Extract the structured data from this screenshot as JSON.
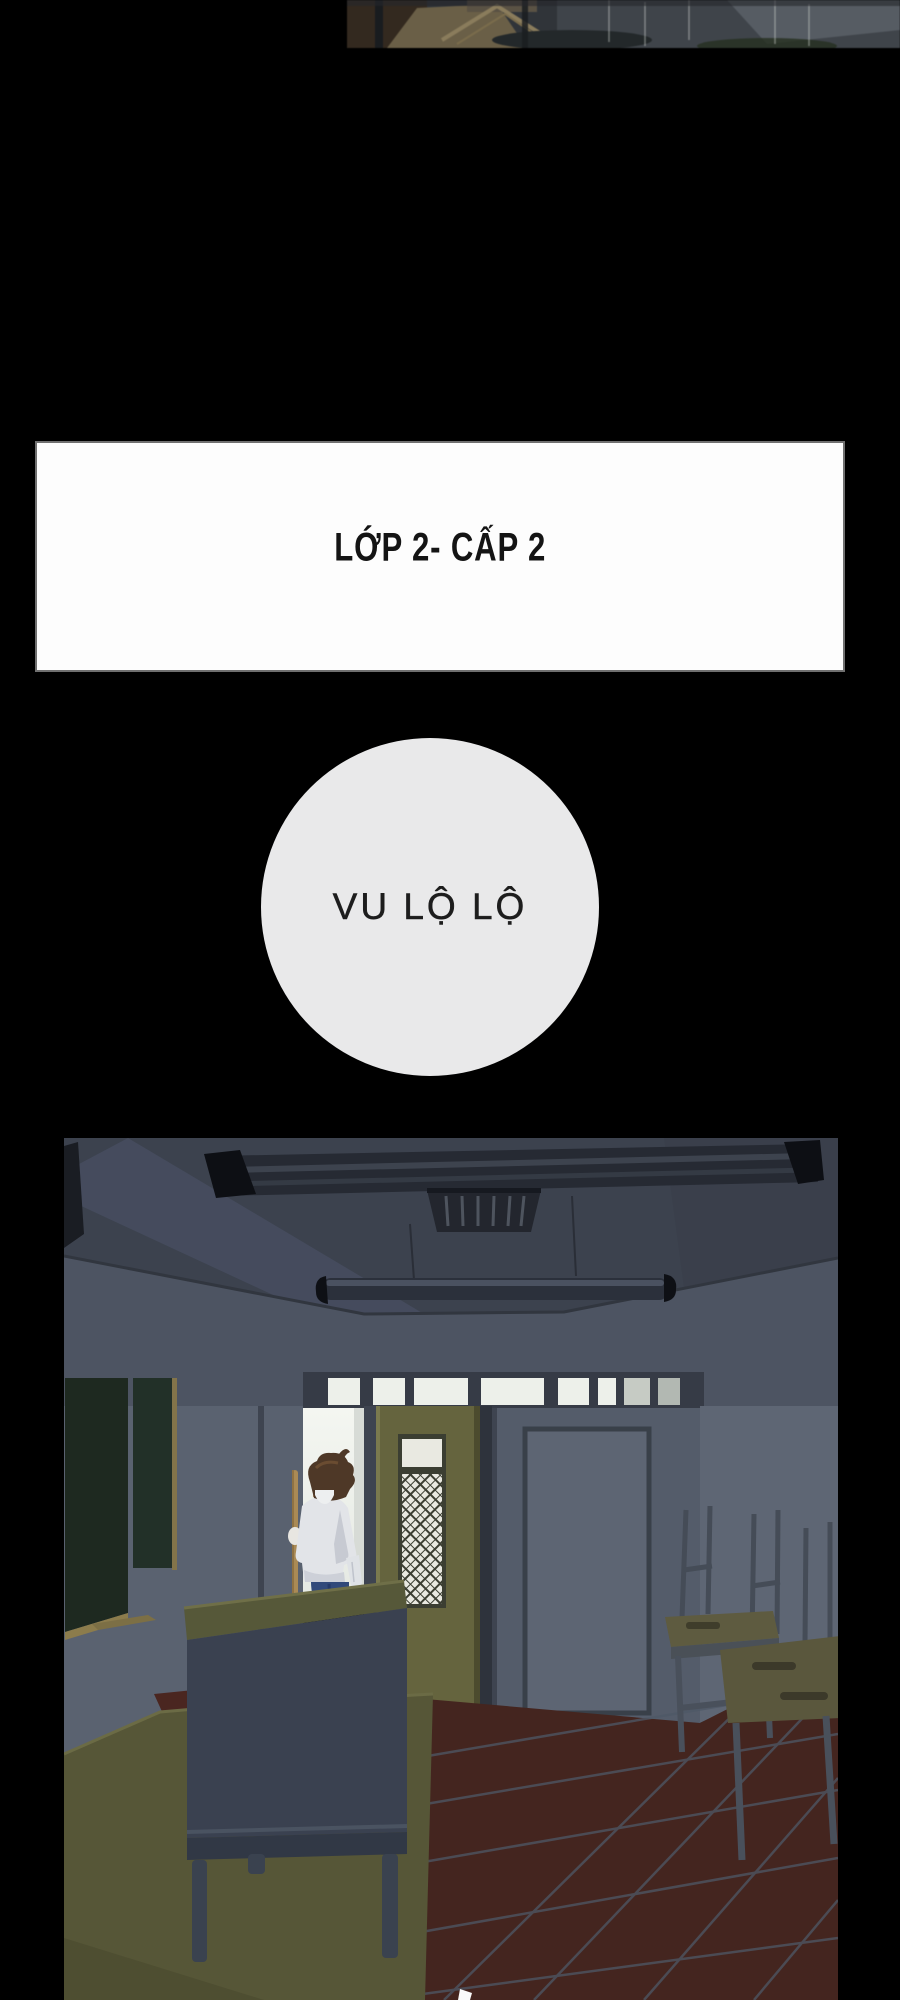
{
  "page": {
    "width": 900,
    "height": 2000,
    "background": "#000000"
  },
  "top_strip": {
    "description": "dark cropped classroom photo fragment at top edge of comic page"
  },
  "title_box": {
    "text": "LỚP 2- CẤP 2",
    "background": "#fdfdfd",
    "border_color": "#707070",
    "text_color": "#141414"
  },
  "name_circle": {
    "text": "VU LỘ LỘ",
    "background": "#e9e9ea",
    "text_color": "#1d1d1d"
  },
  "classroom_scene": {
    "description": "dim classroom at dusk: boy in white shirt and mask holding a broom stands in a bright doorway behind the teacher podium; blackboard on left wall, olive door with lattice window, closed gray door with notice panel, stacked desks and upturned chairs on right, dark red tiled floor, fluorescent ceiling lights and vent",
    "colors": {
      "ceiling": "#3c424e",
      "wall": "#5a6270",
      "wall_band": "#4d5462",
      "blackboard": "#1e2920",
      "blackboard_frame": "#8c7c4c",
      "door_olive": "#65643e",
      "door_gray": "#545c6a",
      "doorway_light": "#f2f4ef",
      "podium_top": "#565839",
      "podium_front": "#3a4150",
      "platform": "#565637",
      "floor_tile": "#44251f",
      "floor_grout": "#4e5866",
      "desk_top": "#5e5b40",
      "shirt": "#e2e4e8",
      "jeans": "#31497a",
      "hair": "#4e3827",
      "broom": "#aa8a55"
    }
  },
  "css_vars": {
    "--page-bg": "#000000",
    "--title-box-bg": "#fdfdfd",
    "--title-box-border": "#707070",
    "--title-color": "#141414",
    "--circle-bg": "#e9e9ea",
    "--circle-color": "#1d1d1d"
  }
}
